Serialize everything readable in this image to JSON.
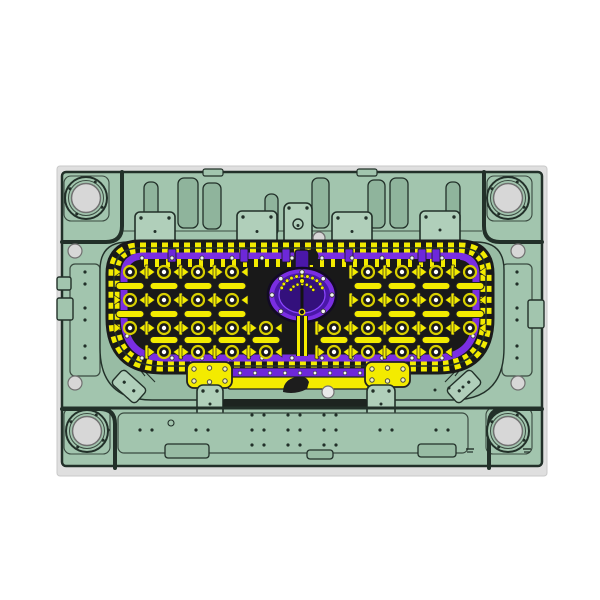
{
  "palette": {
    "bg": "#ffffff",
    "frame_grey": "#dfdfdf",
    "plate_green": "#a2c5ae",
    "pocket_green": "#98bca4",
    "block_green": "#b0cfba",
    "slot_green": "#8fb49c",
    "outline": "#223029",
    "line_soft": "#3a4a40",
    "yellow": "#f3eb00",
    "yellow_edge": "#6b6400",
    "purple": "#7a2ee2",
    "purple_strip": "#6d28d9",
    "purple_mid": "#4a17a8",
    "purple_deep": "#33107c",
    "cavity_dark": "#191919",
    "steel_grey": "#d7d7d7",
    "steel_edge": "#707070",
    "white_dot": "#f4f4f4",
    "screw_light": "#f7f3c0"
  },
  "scene": {
    "frame": [
      57,
      166,
      490,
      310
    ],
    "plate": [
      62,
      172,
      480,
      294
    ],
    "bushing_squares": [
      [
        64,
        176,
        45,
        45
      ],
      [
        487,
        176,
        45,
        45
      ],
      [
        64,
        408,
        46,
        46
      ],
      [
        486,
        408,
        46,
        46
      ]
    ],
    "bushings": {
      "pts": [
        [
          86,
          198
        ],
        [
          508,
          198
        ],
        [
          87,
          431
        ],
        [
          508,
          431
        ]
      ],
      "r_ring": 21,
      "r_steel": 14.5
    },
    "corner_paths": [
      "M62,242 H106 Q122,242 122,226 V172",
      "M542,242 H500 Q484,242 484,226 V172",
      "M62,409 H100 Q115,409 115,424 V468",
      "M542,409 H504 Q489,409 489,424 V468"
    ],
    "tabs": [
      [
        203,
        169,
        20,
        7
      ],
      [
        357,
        169,
        20,
        7
      ]
    ],
    "ledge_line": [
      122,
      231,
      482,
      231
    ],
    "top_slots": [
      [
        144,
        182,
        14,
        44
      ],
      [
        178,
        178,
        20,
        50
      ],
      [
        203,
        183,
        18,
        46
      ],
      [
        265,
        194,
        13,
        42
      ],
      [
        312,
        178,
        17,
        50
      ],
      [
        368,
        180,
        17,
        48
      ],
      [
        390,
        178,
        18,
        50
      ],
      [
        446,
        182,
        14,
        44
      ]
    ],
    "top_plates": [
      [
        135,
        212,
        40,
        39
      ],
      [
        237,
        211,
        40,
        41
      ],
      [
        332,
        212,
        40,
        39
      ],
      [
        420,
        211,
        40,
        38
      ]
    ],
    "hole_block": [
      284,
      203,
      28,
      45
    ],
    "hole_block_hole": [
      298,
      224,
      5
    ],
    "sprue": [
      319,
      238,
      6
    ],
    "pocket": [
      100,
      242,
      404,
      158,
      28,
      52
    ],
    "ribs": [
      [
        112,
        296,
        136,
        256
      ],
      [
        118,
        306,
        146,
        262
      ],
      [
        126,
        314,
        156,
        268
      ],
      [
        488,
        296,
        464,
        256
      ],
      [
        482,
        306,
        454,
        262
      ],
      [
        474,
        314,
        444,
        268
      ],
      [
        112,
        330,
        135,
        368
      ],
      [
        118,
        342,
        145,
        376
      ],
      [
        126,
        352,
        155,
        382
      ],
      [
        488,
        330,
        465,
        368
      ],
      [
        482,
        342,
        455,
        376
      ],
      [
        474,
        352,
        445,
        382
      ]
    ],
    "grille_outer": [
      114,
      248,
      372,
      118,
      26,
      48
    ],
    "grille_band": [
      124,
      256,
      352,
      102,
      20,
      42
    ],
    "inner_teeth": [
      140,
      263,
      460,
      263
    ],
    "top_purple_patches": [
      168,
      240,
      282,
      345,
      418,
      432
    ],
    "top_hook": "M304,262 q-3,-9 4,-12 q8,-3 10,4 q2,6 -5,8 l0,3 h-6 z",
    "rows_boss": [
      272,
      300,
      328,
      352
    ],
    "rows_slat": [
      286,
      314,
      340
    ],
    "cols": {
      "start": 130,
      "step": 34,
      "count": 11
    },
    "skip_boss": [
      [
        4,
        0
      ],
      [
        5,
        0
      ],
      [
        6,
        0
      ],
      [
        4,
        1
      ],
      [
        5,
        1
      ],
      [
        6,
        1
      ],
      [
        5,
        2
      ],
      [
        0,
        3
      ],
      [
        5,
        3
      ],
      [
        10,
        3
      ]
    ],
    "skip_slat": [
      [
        4,
        0
      ],
      [
        5,
        0
      ],
      [
        6,
        0
      ],
      [
        4,
        1
      ],
      [
        5,
        1
      ],
      [
        6,
        1
      ],
      [
        0,
        2
      ],
      [
        5,
        2
      ],
      [
        10,
        2
      ]
    ],
    "perimeter_dots": {
      "top_y": 258,
      "bottom_y": 358,
      "x_start": 142,
      "x_end": 458,
      "x_step": 30,
      "left_x": 127,
      "right_x": 473,
      "side_ys": [
        276,
        296,
        316,
        336
      ]
    },
    "emblem": {
      "cx": 302,
      "cy": 295,
      "rx": 34,
      "ry": 27,
      "stem": [
        295,
        250,
        14,
        20
      ]
    },
    "emblem_channel": [
      296,
      316,
      12,
      40
    ],
    "bottom_purple": [
      232,
      368,
      133,
      10
    ],
    "bottom_purple_dots": {
      "y": 373,
      "x0": 240,
      "x1": 360,
      "step": 15
    },
    "bottom_yellow": [
      228,
      377,
      140,
      12
    ],
    "hook": "M283,392 q0,-12 13,-15 q10,-2 13,5 l-2,7 q-12,6 -24,3 Z",
    "white_circle": [
      328,
      392,
      6
    ],
    "yellow_plates": [
      [
        187,
        362,
        45,
        26
      ],
      [
        365,
        362,
        45,
        25
      ]
    ],
    "green_clamps": [
      [
        197,
        385,
        26,
        38
      ],
      [
        367,
        385,
        28,
        38
      ]
    ],
    "tilted_blocks": [
      [
        113,
        377,
        32,
        19,
        42
      ],
      [
        448,
        377,
        32,
        19,
        -42
      ]
    ],
    "side_strips": [
      [
        70,
        264,
        30,
        112
      ],
      [
        502,
        264,
        30,
        112
      ]
    ],
    "strip_dot_cols": [
      85,
      517
    ],
    "strip_dot_ys": [
      272,
      284,
      308,
      320,
      346,
      358
    ],
    "grey_pins": [
      [
        75,
        251
      ],
      [
        75,
        383
      ],
      [
        518,
        251
      ],
      [
        518,
        383
      ]
    ],
    "edge_notches": [
      [
        57,
        277,
        14,
        13
      ],
      [
        57,
        298,
        16,
        22
      ],
      [
        528,
        300,
        16,
        28
      ]
    ],
    "groove_line": [
      62,
      408,
      542,
      408
    ],
    "groove_rect": [
      223,
      399,
      144,
      9
    ],
    "bottom_panel": [
      118,
      413,
      350,
      40
    ],
    "bottom_notches": [
      [
        165,
        444,
        44,
        14
      ],
      [
        418,
        444,
        38,
        13
      ],
      [
        307,
        450,
        26,
        9
      ]
    ],
    "bottom_dots": [
      [
        252,
        415
      ],
      [
        264,
        415
      ],
      [
        288,
        415
      ],
      [
        300,
        415
      ],
      [
        324,
        415
      ],
      [
        336,
        415
      ],
      [
        96,
        430
      ],
      [
        108,
        430
      ],
      [
        140,
        430
      ],
      [
        152,
        430
      ],
      [
        196,
        430
      ],
      [
        208,
        430
      ],
      [
        252,
        430
      ],
      [
        264,
        430
      ],
      [
        288,
        430
      ],
      [
        300,
        430
      ],
      [
        324,
        430
      ],
      [
        336,
        430
      ],
      [
        380,
        430
      ],
      [
        392,
        430
      ],
      [
        436,
        430
      ],
      [
        448,
        430
      ],
      [
        252,
        445
      ],
      [
        264,
        445
      ],
      [
        288,
        445
      ],
      [
        300,
        445
      ],
      [
        324,
        445
      ],
      [
        336,
        445
      ]
    ],
    "extra_dots": [
      [
        435,
        390
      ],
      [
        449,
        388
      ],
      [
        463,
        387
      ]
    ],
    "small_ring": [
      171,
      423
    ],
    "engraved_marks": [
      [
        470,
        449
      ],
      [
        527,
        449
      ]
    ]
  }
}
